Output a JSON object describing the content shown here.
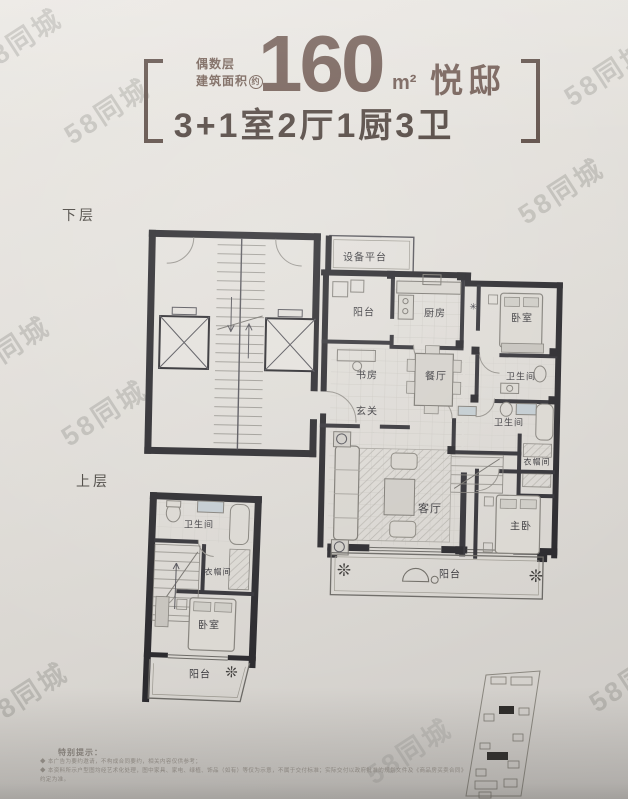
{
  "watermark": {
    "text": "58同城"
  },
  "header": {
    "floor_parity": "偶数层",
    "area_label": "建筑面积",
    "area_circle_mark": "约",
    "area_value": "160",
    "area_unit": "m²",
    "suite_name": "悦邸",
    "layout_line": "3+1室2厅1厨3卫"
  },
  "floor_labels": {
    "lower": "下层",
    "upper": "上层"
  },
  "lower_rooms": [
    {
      "label": "设备平台"
    },
    {
      "label": "阳台"
    },
    {
      "label": "厨房"
    },
    {
      "label": "卧室"
    },
    {
      "label": "书房"
    },
    {
      "label": "餐厅"
    },
    {
      "label": "卫生间"
    },
    {
      "label": "玄关"
    },
    {
      "label": "卫生间"
    },
    {
      "label": "衣帽间"
    },
    {
      "label": "客厅"
    },
    {
      "label": "主卧"
    },
    {
      "label": "阳台"
    }
  ],
  "upper_rooms": [
    {
      "label": "卫生间"
    },
    {
      "label": "衣帽间"
    },
    {
      "label": "卧室"
    },
    {
      "label": "阳台"
    }
  ],
  "symbols": {
    "flue": "✳",
    "plant": "❊"
  },
  "disclaimer": {
    "title": "特别提示：",
    "line1": "◆ 本广告为要约邀请，不构成合同要约，相关内容仅供参考；",
    "line2": "◆ 本资料所示户型图均经艺术化处理，图中家具、家电、绿植、饰品（如有）等仅为示意，不属于交付标准；实际交付以政府批准的规划文件及《商品房买卖合同》约定为准。"
  },
  "colors": {
    "header_brown": "#6e5850",
    "wall_black": "#2a292d",
    "background": "#dfdcd7"
  }
}
